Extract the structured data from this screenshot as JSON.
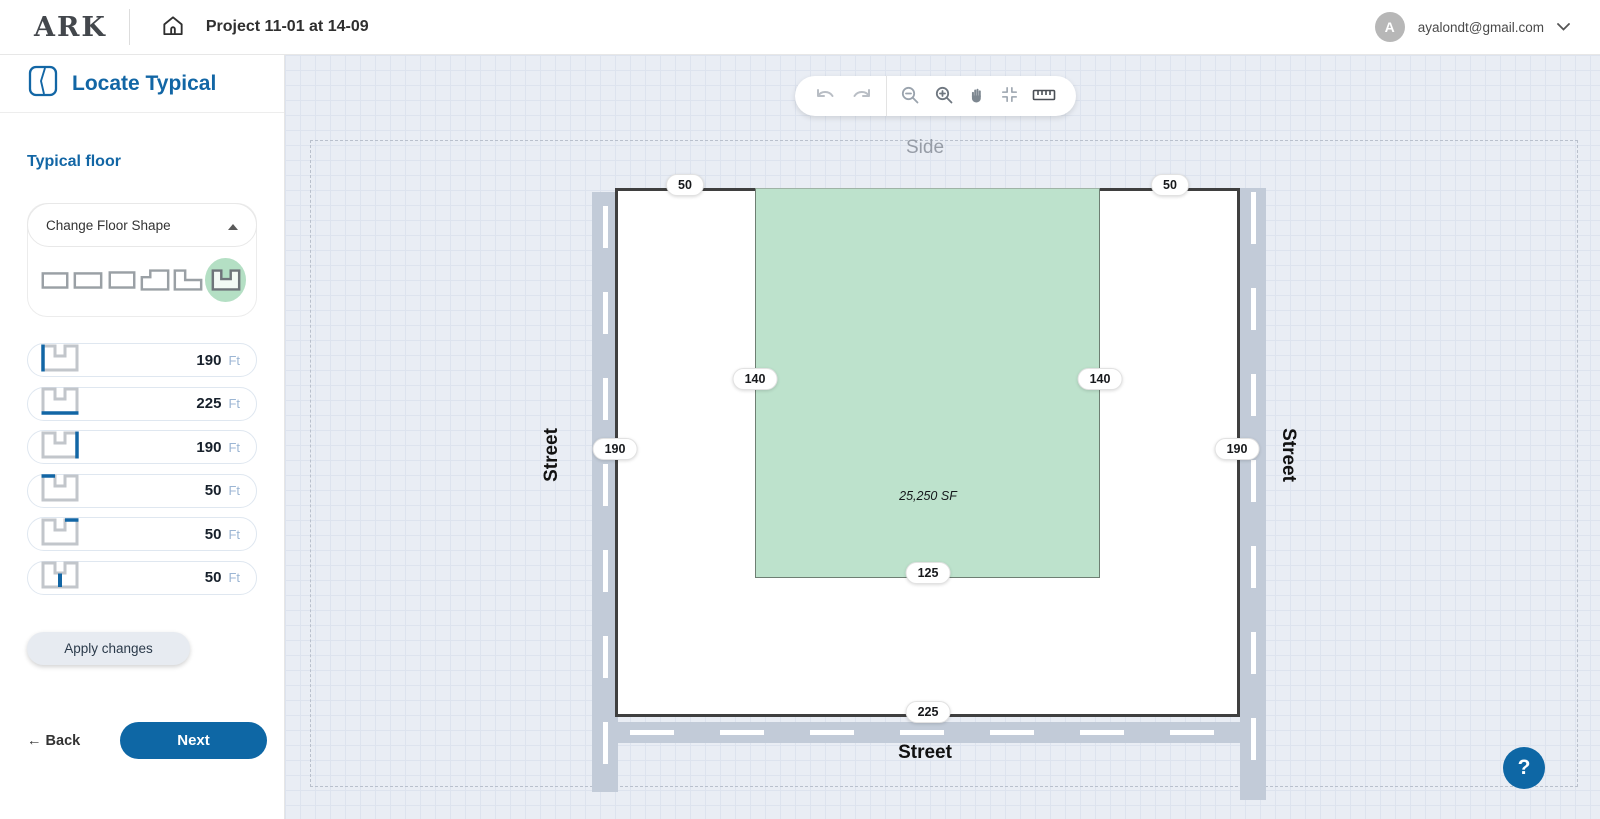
{
  "header": {
    "logo": "ARK",
    "project_title": "Project 11-01 at 14-09",
    "avatar_initial": "A",
    "user_email": "ayalondt@gmail.com"
  },
  "sidebar": {
    "step_title": "Locate Typical",
    "section_title": "Typical floor",
    "shape_selector": {
      "label": "Change Floor Shape",
      "shapes": [
        "rectangle-wide",
        "rectangle",
        "rectangle-small",
        "l-shape-notch-top-left",
        "l-shape-notch-top-right",
        "u-shape"
      ],
      "selected_shape": "u-shape"
    },
    "dimensions": [
      {
        "edge": "left-side",
        "value": "190",
        "unit": "Ft"
      },
      {
        "edge": "bottom-side",
        "value": "225",
        "unit": "Ft"
      },
      {
        "edge": "right-side",
        "value": "190",
        "unit": "Ft"
      },
      {
        "edge": "top-left-wing",
        "value": "50",
        "unit": "Ft"
      },
      {
        "edge": "top-right-wing",
        "value": "50",
        "unit": "Ft"
      },
      {
        "edge": "below-notch",
        "value": "50",
        "unit": "Ft"
      }
    ],
    "apply_button": "Apply changes",
    "back": {
      "arrow": "←",
      "label": "Back"
    },
    "next_label": "Next"
  },
  "toolbar": {
    "icons": [
      "undo",
      "redo",
      "zoom-out",
      "zoom-in",
      "pan-hand",
      "fit-to-screen",
      "ruler"
    ]
  },
  "plan": {
    "label_top": "Side",
    "label_left": "Street",
    "label_right": "Street",
    "label_bottom": "Street",
    "area_label": "25,250 SF",
    "dims": {
      "wing_top_left": "50",
      "wing_top_right": "50",
      "notch_side_left": "140",
      "notch_side_right": "140",
      "lot_side_left": "190",
      "lot_side_right": "190",
      "notch_bottom": "125",
      "lot_bottom": "225"
    }
  },
  "help_label": "?",
  "colors": {
    "accent_blue": "#0e67a5",
    "notch_green": "#bde2cc",
    "selected_circle_green": "#b4dfc4",
    "street_band": "#c2cbd8",
    "canvas_bg": "#e9edf4",
    "building_border": "#3f3f3f"
  }
}
